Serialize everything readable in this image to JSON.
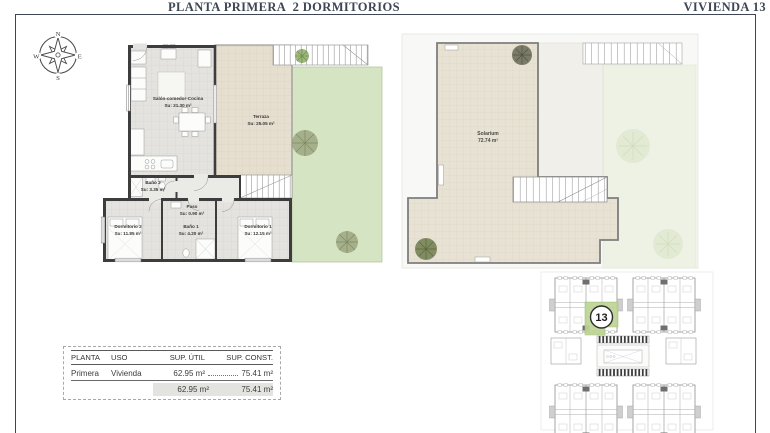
{
  "header": {
    "title": "PLANTA PRIMERA  2 DORMITORIOS",
    "unit": "VIVIENDA 13"
  },
  "compass": {
    "north": "N",
    "east": "E",
    "south": "S",
    "west": "W"
  },
  "floor_plan": {
    "living": {
      "name": "Salón-comedor-Cocina",
      "area": "Su: 31.30 m²"
    },
    "terrace": {
      "name": "Terraza",
      "area": "Su: 25.05 m²"
    },
    "bath2": {
      "name": "Baño 2",
      "area": "Su: 3.35 m²"
    },
    "hall": {
      "name": "Paso",
      "area": "Su: 0.90 m²"
    },
    "bedroom2": {
      "name": "Dormitorio 2",
      "area": "Su: 11.85 m²"
    },
    "bath1": {
      "name": "Baño 1",
      "area": "Su: 4.20 m²"
    },
    "bedroom1": {
      "name": "Dormitorio 1",
      "area": "Su: 12.15 m²"
    }
  },
  "solarium_plan": {
    "name": "Solarium",
    "area": "72.74 m²"
  },
  "key_plan": {
    "highlighted_unit": "13"
  },
  "areas_table": {
    "headers": [
      "PLANTA",
      "USO",
      "SUP. ÚTIL",
      "SUP. CONST."
    ],
    "row": {
      "planta": "Primera",
      "uso": "Vivienda",
      "sup_util": "62.95 m²",
      "sup_const": "75.41 m²"
    },
    "totals": {
      "sup_util": "62.95 m²",
      "sup_const": "75.41 m²"
    }
  },
  "colors": {
    "accent": "#3e4654",
    "garden_green": "#d5e4c3",
    "solarium_floor": "#e7e0d1",
    "highlight_green": "#bcd493"
  }
}
